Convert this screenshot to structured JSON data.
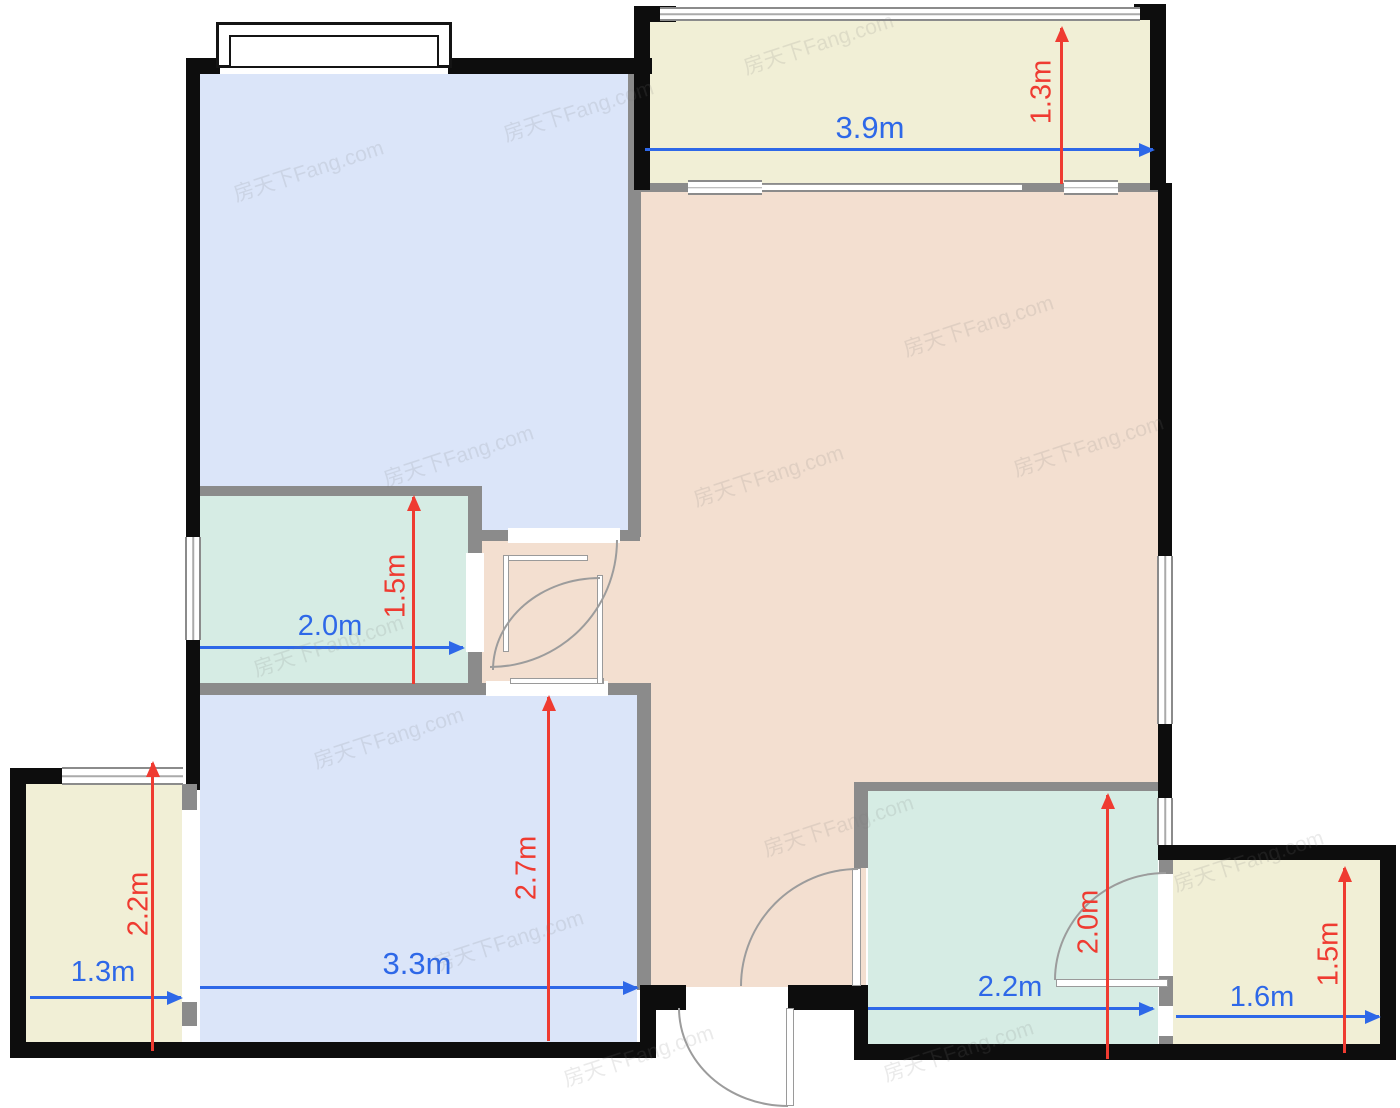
{
  "watermark": {
    "text": "房天下Fang.com"
  },
  "colors": {
    "exterior_wall": "#0d0d0d",
    "interior_wall": "#8b8b8b",
    "bedroom_fill": "#dbe5f9",
    "living_fill": "#f3dfd0",
    "wet_room_fill": "#d6ece4",
    "balcony_fill": "#f1efd6",
    "dimension_blue": "#2e68e8",
    "dimension_red": "#ef3b31"
  },
  "dimensions": {
    "top_balcony": {
      "width": "3.9m",
      "depth": "1.3m"
    },
    "bathroom": {
      "width": "2.0m",
      "depth": "1.5m"
    },
    "bottom_bedroom": {
      "width": "3.3m",
      "depth": "2.7m"
    },
    "left_balcony": {
      "width": "1.3m",
      "depth": "2.2m"
    },
    "kitchen": {
      "width": "2.2m",
      "depth": "2.0m"
    },
    "right_balcony": {
      "width": "1.6m",
      "depth": "1.5m"
    }
  }
}
